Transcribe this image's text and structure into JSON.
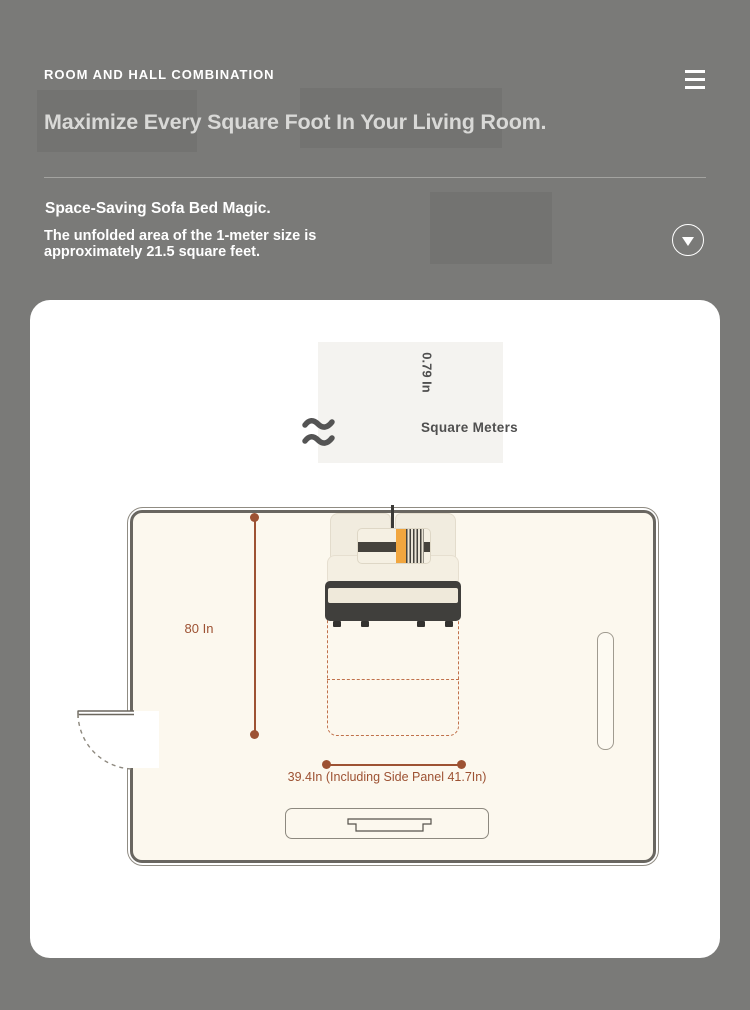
{
  "page": {
    "background_color": "#7a7a78",
    "accent_color": "#9d5233",
    "room_floor_color": "#fcf8ee",
    "pillow_accent_color": "#f1a63f"
  },
  "header": {
    "brand": "ROOM AND HALL COMBINATION"
  },
  "hero": {
    "headline": "Maximize Every Square Foot In Your Living Room."
  },
  "feature": {
    "title": "Space-Saving Sofa Bed Magic.",
    "description": "The unfolded area of the 1-meter size is approximately 21.5 square feet."
  },
  "diagram": {
    "depth_label": "0.79 In",
    "unit_label": "Square Meters",
    "height_label": "80 In",
    "width_label": "39.4In (Including Side Panel 41.7In)"
  },
  "icons": {
    "menu": "hamburger-icon",
    "expand": "chevron-down-icon",
    "approx": "approx-squiggle-icon"
  }
}
